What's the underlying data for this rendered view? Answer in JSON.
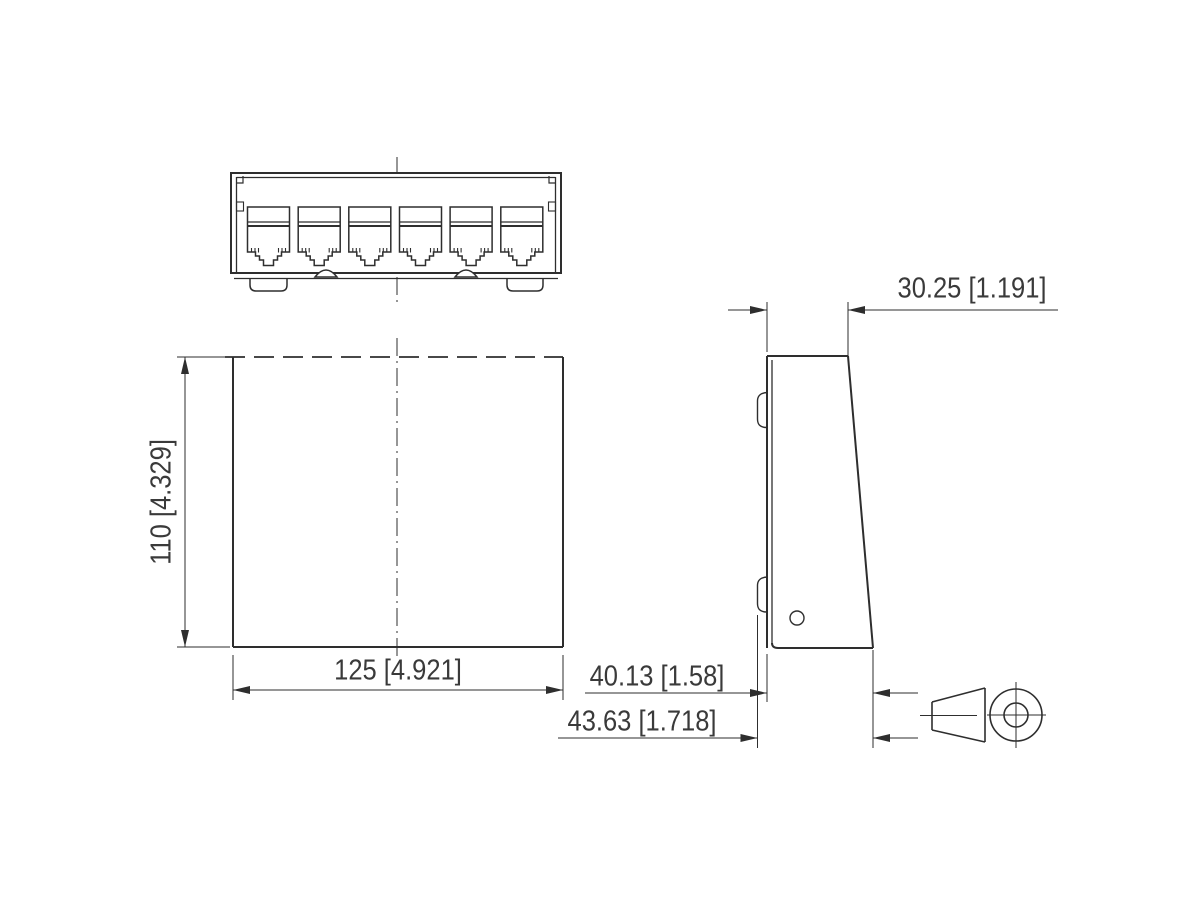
{
  "drawing": {
    "ports": 6,
    "dimensions": {
      "front_height": "110 [4.329]",
      "front_width": "125 [4.921]",
      "side_top_depth": "30.25 [1.191]",
      "side_body_depth": "40.13 [1.58]",
      "side_total_depth": "43.63 [1.718]"
    },
    "colors": {
      "line": "#2e2e2e",
      "text": "#3a3a3a",
      "background": "#ffffff"
    }
  }
}
